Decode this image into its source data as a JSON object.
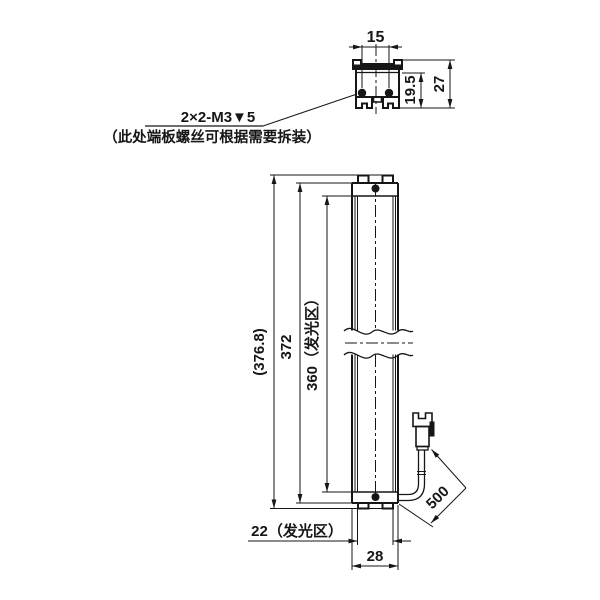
{
  "colors": {
    "line": "#161616",
    "background": "#ffffff"
  },
  "section_view": {
    "dim_screw_spacing": "15",
    "dim_inner_height": "19.5",
    "dim_overall_height": "27"
  },
  "callout": {
    "thread_spec": "2×2-M3▼5",
    "note": "（此处端板螺丝可根据需要拆装）"
  },
  "front_view": {
    "dim_overall_length": "(376.8)",
    "dim_body_length": "372",
    "dim_glow_length": "360（发光区）",
    "dim_glow_width": "22（发光区）",
    "dim_overall_width": "28",
    "dim_cable_length": "500"
  }
}
